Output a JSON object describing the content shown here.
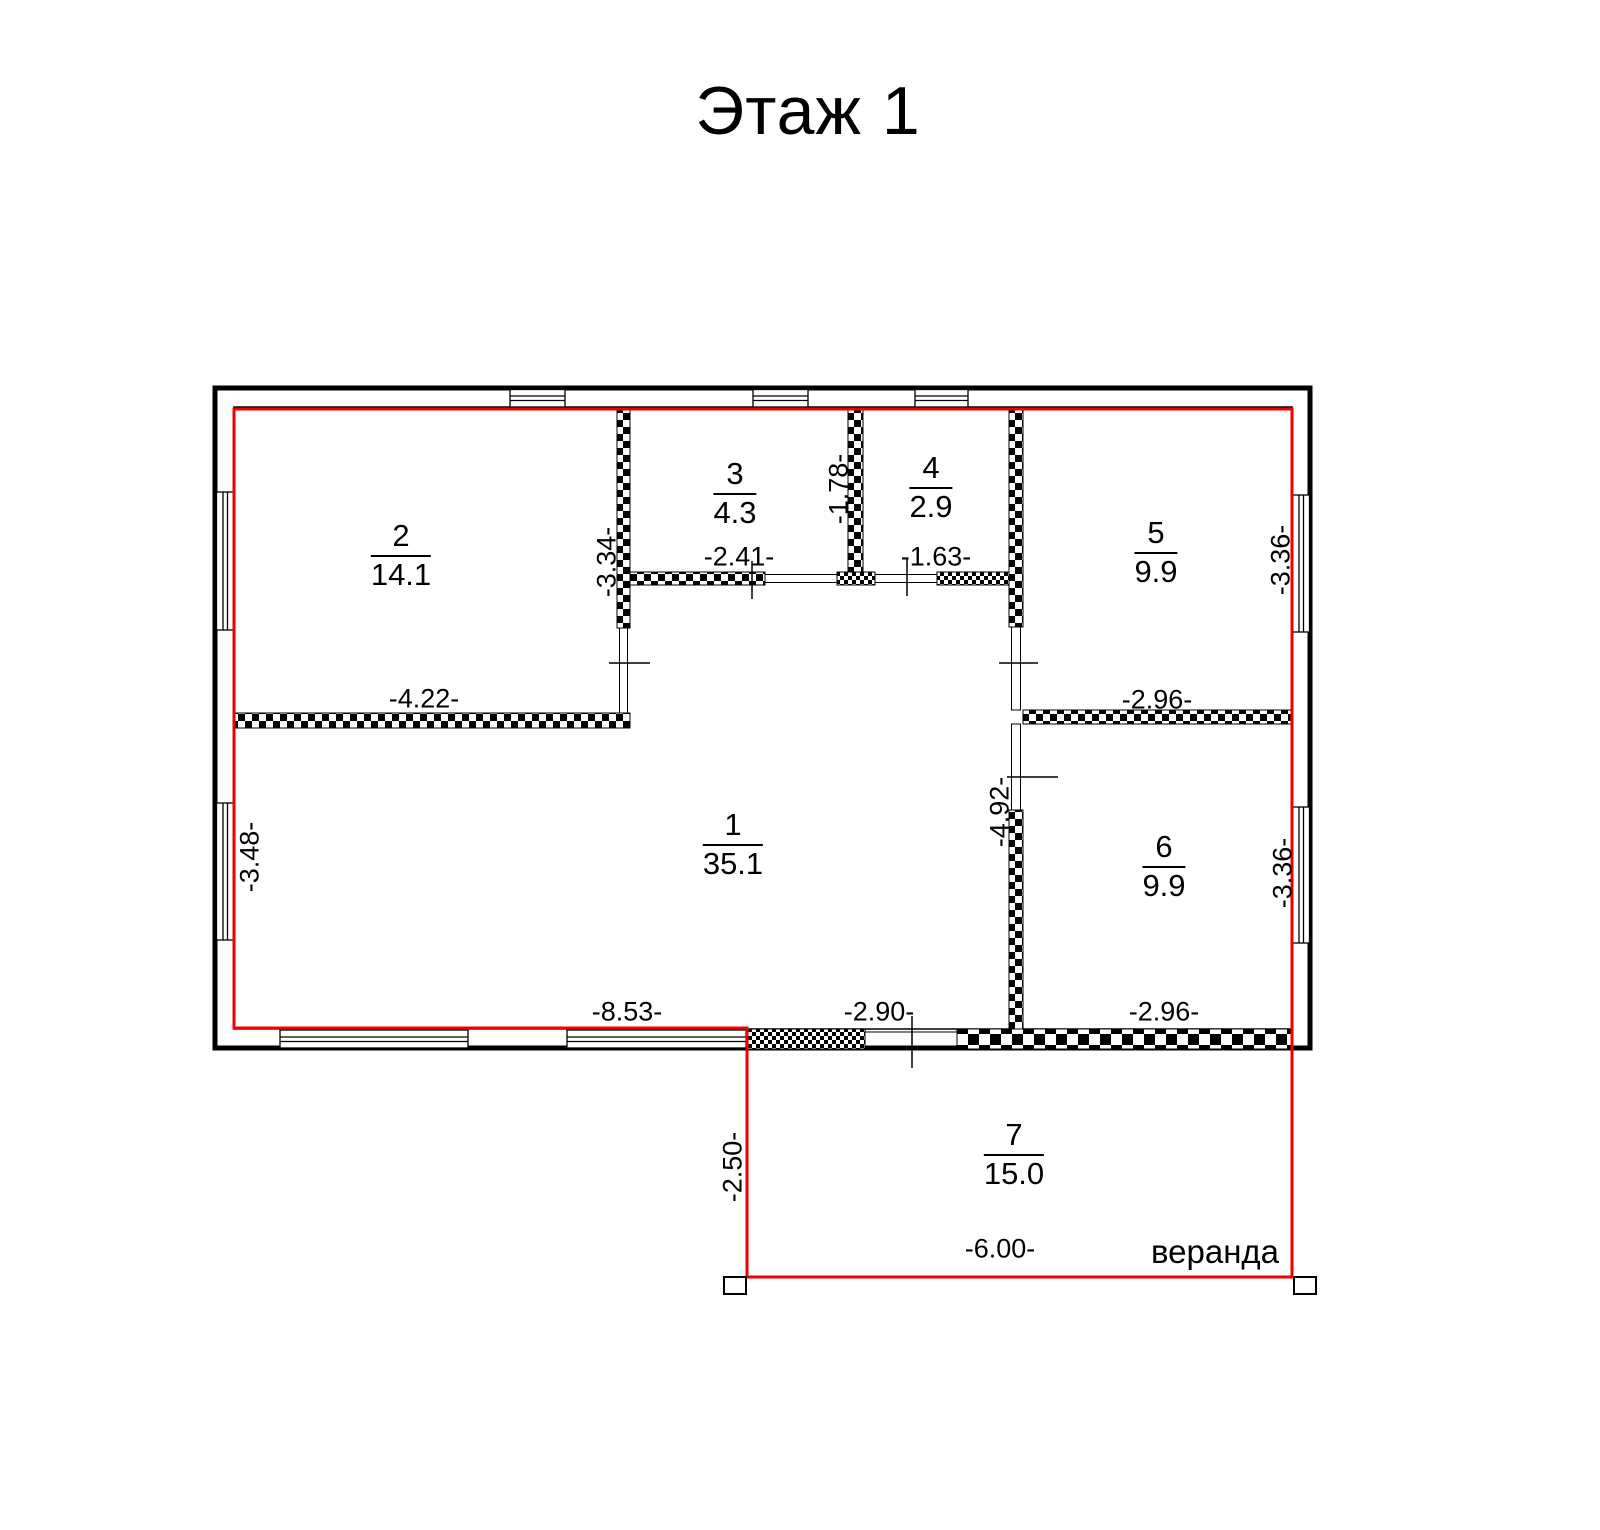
{
  "title": "Этаж 1",
  "colors": {
    "wall": "#000000",
    "outline_red": "#f20000",
    "background": "#ffffff"
  },
  "rooms": [
    {
      "number": "1",
      "area": "35.1"
    },
    {
      "number": "2",
      "area": "14.1"
    },
    {
      "number": "3",
      "area": "4.3"
    },
    {
      "number": "4",
      "area": "2.9"
    },
    {
      "number": "5",
      "area": "9.9"
    },
    {
      "number": "6",
      "area": "9.9"
    },
    {
      "number": "7",
      "area": "15.0"
    }
  ],
  "dimensions": {
    "room3_height": "-3.34-",
    "room3_width": "-2.41-",
    "room4_height": "-1.78-",
    "room4_width": "-1.63-",
    "room5_height": "-3.36-",
    "room2_width": "-4.22-",
    "room5_width": "-2.96-",
    "room1_height": "-3.48-",
    "hall_height": "-4.92-",
    "room6_height": "-3.36-",
    "room1_width": "-8.53-",
    "veranda_door_width": "-2.90-",
    "room6_width": "-2.96-",
    "veranda_depth": "-2.50-",
    "veranda_width": "-6.00-"
  },
  "veranda_label": "веранда"
}
